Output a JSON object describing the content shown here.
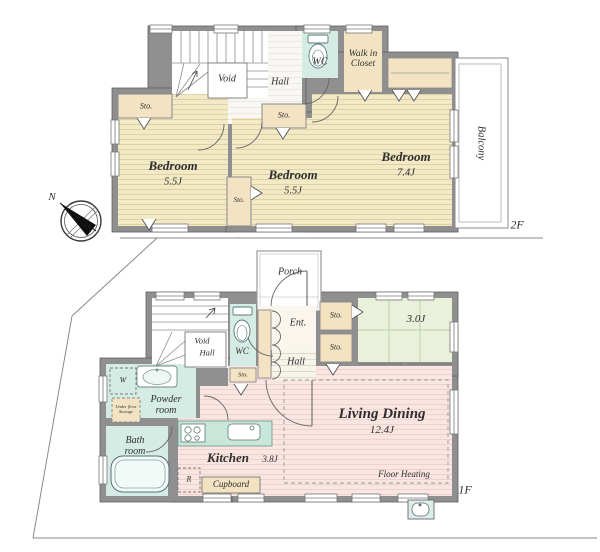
{
  "plan": {
    "floor2": {
      "label": "2F",
      "rooms": {
        "bedroom1": {
          "name": "Bedroom",
          "area": "5.5J"
        },
        "bedroom2": {
          "name": "Bedroom",
          "area": "5.5J"
        },
        "bedroom3": {
          "name": "Bedroom",
          "area": "7.4J"
        },
        "walk_in_closet": {
          "name": "Walk in Closet"
        },
        "wc": {
          "name": "WC"
        },
        "hall": {
          "name": "Hall"
        },
        "void": {
          "name": "Void"
        },
        "balcony": {
          "name": "Balcony"
        },
        "storage_a": {
          "name": "Sto."
        },
        "storage_b": {
          "name": "Sto."
        },
        "storage_c": {
          "name": "Sto."
        }
      }
    },
    "floor1": {
      "label": "1F",
      "rooms": {
        "porch": {
          "name": "Porch"
        },
        "entrance": {
          "name": "Ent."
        },
        "hall": {
          "name": "Hall"
        },
        "wc": {
          "name": "WC"
        },
        "stair_void": {
          "name": "Void"
        },
        "stair_hall": {
          "name": "Hall"
        },
        "tatami": {
          "name": "3.0J"
        },
        "powder_room": {
          "name": "Powder room"
        },
        "washer": {
          "name": "W"
        },
        "under_floor_storage": {
          "name": "Under floor Storage"
        },
        "bath_room": {
          "name": "Bath room"
        },
        "kitchen": {
          "name": "Kitchen",
          "area": "3.8J"
        },
        "refrigerator": {
          "name": "R"
        },
        "cupboard": {
          "name": "Cupboard"
        },
        "living_dining": {
          "name": "Living Dining",
          "area": "12.4J"
        },
        "floor_heating": {
          "name": "Floor Heating"
        },
        "storage_wc": {
          "name": "Sto."
        },
        "storage_1": {
          "name": "Sto."
        },
        "storage_2": {
          "name": "Sto."
        }
      }
    },
    "compass": {
      "north": "N"
    },
    "colors": {
      "wall": "#8f8f8f",
      "bedroom_floor": "#f2e9c7",
      "tatami_floor": "#e9f1da",
      "ldk_floor": "#f9e6e3",
      "wet_area": "#d5ece4",
      "storage": "#f3e3c2"
    }
  }
}
